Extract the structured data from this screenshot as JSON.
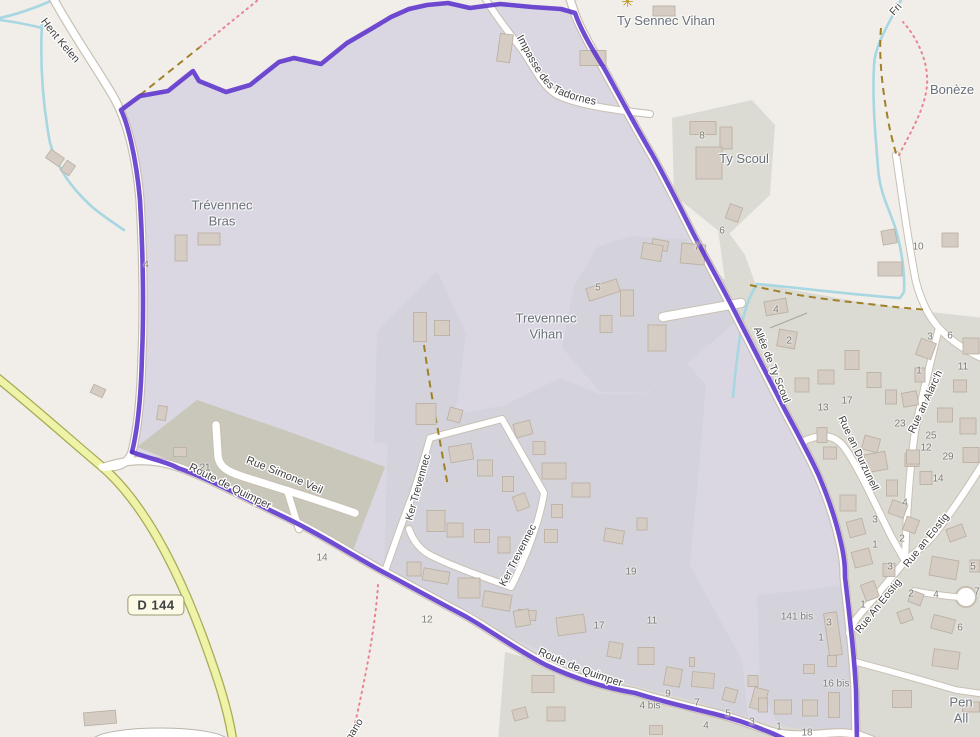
{
  "route_badge": "D 144",
  "place_labels": {
    "trevennec_bras": "Trévennec\nBras",
    "trevennec_vihan": "Trevennec\nVihan",
    "ty_sennec_vihan": "Ty Sennec Vihan",
    "ty_scoul": "Ty Scoul",
    "boneze": "Bonèze",
    "pen_all": "Pen All"
  },
  "road_labels": {
    "hent_kelen": "Hent Kelen",
    "impasse": "Impasse des Tadornes",
    "allee_ty_scoul": "Allée de Ty Scoul",
    "rue_simone_veil": "Rue Simone Veil",
    "route_quimper_upper": "Route de Quimper",
    "route_quimper_lower": "Route de Quimper",
    "ker_trevennec_w": "Ker Trevennec",
    "ker_trevennec_e": "Ker Trevennec",
    "rue_an_alarch": "Rue an Alarc'h",
    "rue_an_durzunell": "Rue an Durzunell",
    "rue_an_eostig_upper": "Rue an Eostig",
    "rue_an_eostig_lower": "Rue An Eostig"
  },
  "partial_labels": {
    "ergano": "ergano",
    "fri": "Fri"
  },
  "icons": {
    "attraction_glyph": "✳"
  },
  "house_numbers": [
    "4",
    "8",
    "6",
    "7",
    "5",
    "4",
    "2",
    "10",
    "3",
    "6",
    "11",
    "1",
    "13",
    "17",
    "23",
    "25",
    "12",
    "29",
    "14",
    "4",
    "3",
    "2",
    "1",
    "3",
    "5",
    "7",
    "2",
    "4",
    "6",
    "1",
    "21",
    "14",
    "12",
    "19",
    "17",
    "11",
    "9",
    "4 bis",
    "7",
    "5",
    "4",
    "3",
    "1",
    "18",
    "141 bis",
    "3",
    "1",
    "16 bis"
  ],
  "colors": {
    "background": "#f1eee9",
    "boundary": "#5c33cc",
    "boundary_fill": "#dbd7e2",
    "residential_inside": "#d4d3db",
    "residential_outside": "#dbdad3",
    "farmyard": "#c9c7ba",
    "road_fill": "#ffffff",
    "primary_road_fill": "#eff3a8",
    "water": "#a8d7e2",
    "path_khaki": "#a08027",
    "path_red": "#e8848f",
    "building": "#d5cdc4"
  }
}
